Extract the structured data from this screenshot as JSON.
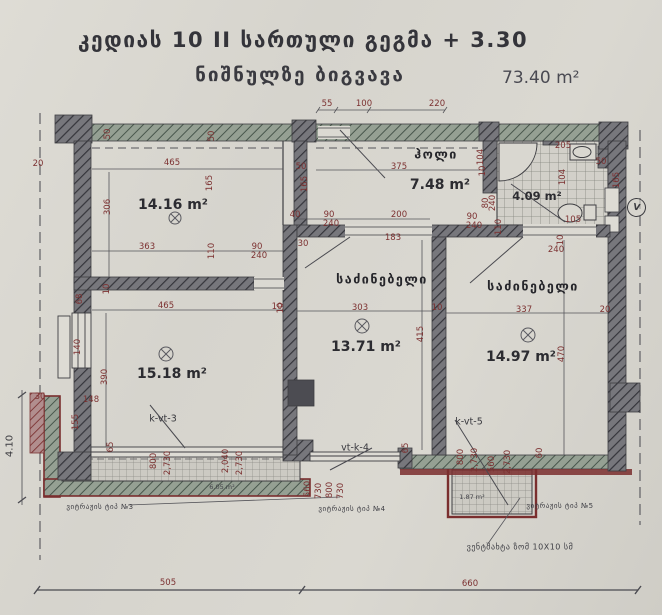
{
  "header": {
    "line1": "კედიას 10 II სართული გეგმა + 3.30",
    "line2": "ნიშნულზე ბიგვავა",
    "total_area": "73.40 m²"
  },
  "rooms": [
    {
      "name": "",
      "area": "14.16 m²"
    },
    {
      "name": "ჰოლი",
      "area": "7.48 m²"
    },
    {
      "name": "",
      "area": "4.09 m²"
    },
    {
      "name": "საძინებელი",
      "area": "13.71 m²"
    },
    {
      "name": "საძინებელი",
      "area": "14.97 m²"
    },
    {
      "name": "",
      "area": "15.18 m²"
    }
  ],
  "window_labels": {
    "left": "k-vt-3",
    "middle": "vt-k-4",
    "right": "k-vt-5"
  },
  "balcony_areas": {
    "left": "6.05 m²",
    "right": "1.87 m²"
  },
  "notes": {
    "type3": "ვიტრაჟის ტიპ №3",
    "type4": "ვიტრაჟის ტიპ №4",
    "type5": "ვიტრაჟის ტიპ №5",
    "vent": "ვენტშახტა ზომ 10X10 სმ",
    "elevation": "4.10",
    "vent_symbol": "V"
  },
  "bottom_dims": {
    "left": "505",
    "right": "660"
  },
  "colors": {
    "paper": "#d6d4cd",
    "ink": "#3b3b40",
    "dimension_text": "#7c3131",
    "wall_dark": "#75757a",
    "wall_green": "#94a092",
    "maroon_band": "#7a2e2e"
  },
  "dim_labels": [
    {
      "t": "55",
      "x": 327,
      "y": 104
    },
    {
      "t": "100",
      "x": 364,
      "y": 104
    },
    {
      "t": "220",
      "x": 437,
      "y": 104
    },
    {
      "t": "50",
      "x": 108,
      "y": 134,
      "r": 1
    },
    {
      "t": "50",
      "x": 212,
      "y": 136,
      "r": 1
    },
    {
      "t": "20",
      "x": 38,
      "y": 164
    },
    {
      "t": "465",
      "x": 172,
      "y": 163
    },
    {
      "t": "165",
      "x": 210,
      "y": 183,
      "r": 1
    },
    {
      "t": "306",
      "x": 108,
      "y": 207,
      "r": 1
    },
    {
      "t": "363",
      "x": 147,
      "y": 247
    },
    {
      "t": "110",
      "x": 212,
      "y": 251,
      "r": 1
    },
    {
      "t": "90",
      "x": 257,
      "y": 247
    },
    {
      "t": "240",
      "x": 259,
      "y": 256
    },
    {
      "t": "50",
      "x": 301,
      "y": 167
    },
    {
      "t": "165",
      "x": 305,
      "y": 184,
      "r": 1
    },
    {
      "t": "40",
      "x": 295,
      "y": 215
    },
    {
      "t": "90",
      "x": 329,
      "y": 215
    },
    {
      "t": "240",
      "x": 331,
      "y": 224
    },
    {
      "t": "30",
      "x": 303,
      "y": 244
    },
    {
      "t": "375",
      "x": 399,
      "y": 167
    },
    {
      "t": "104",
      "x": 481,
      "y": 157,
      "r": 1
    },
    {
      "t": "10",
      "x": 483,
      "y": 171,
      "r": 1
    },
    {
      "t": "80",
      "x": 486,
      "y": 203,
      "r": 1
    },
    {
      "t": "240",
      "x": 493,
      "y": 203,
      "r": 1
    },
    {
      "t": "90",
      "x": 472,
      "y": 217
    },
    {
      "t": "240",
      "x": 474,
      "y": 226
    },
    {
      "t": "110",
      "x": 499,
      "y": 227,
      "r": 1
    },
    {
      "t": "200",
      "x": 399,
      "y": 215
    },
    {
      "t": "183",
      "x": 393,
      "y": 238
    },
    {
      "t": "205",
      "x": 563,
      "y": 146
    },
    {
      "t": "104",
      "x": 563,
      "y": 177,
      "r": 1
    },
    {
      "t": "105",
      "x": 573,
      "y": 220
    },
    {
      "t": "10",
      "x": 561,
      "y": 240,
      "r": 1
    },
    {
      "t": "240",
      "x": 556,
      "y": 250
    },
    {
      "t": "50",
      "x": 601,
      "y": 162
    },
    {
      "t": "165",
      "x": 617,
      "y": 180,
      "r": 1
    },
    {
      "t": "303",
      "x": 360,
      "y": 308
    },
    {
      "t": "10",
      "x": 281,
      "y": 308,
      "r": 1
    },
    {
      "t": "10",
      "x": 437,
      "y": 308
    },
    {
      "t": "415",
      "x": 421,
      "y": 334,
      "r": 1
    },
    {
      "t": "337",
      "x": 524,
      "y": 310
    },
    {
      "t": "20",
      "x": 605,
      "y": 310
    },
    {
      "t": "470",
      "x": 562,
      "y": 354,
      "r": 1
    },
    {
      "t": "465",
      "x": 166,
      "y": 306
    },
    {
      "t": "10",
      "x": 277,
      "y": 307
    },
    {
      "t": "68",
      "x": 80,
      "y": 299,
      "r": 1
    },
    {
      "t": "10",
      "x": 107,
      "y": 289,
      "r": 1
    },
    {
      "t": "140",
      "x": 78,
      "y": 347,
      "r": 1
    },
    {
      "t": "390",
      "x": 105,
      "y": 377,
      "r": 1
    },
    {
      "t": "148",
      "x": 91,
      "y": 400
    },
    {
      "t": "155",
      "x": 76,
      "y": 422,
      "r": 1
    },
    {
      "t": "65",
      "x": 111,
      "y": 447,
      "r": 1
    },
    {
      "t": "30",
      "x": 40,
      "y": 397
    },
    {
      "t": "800",
      "x": 154,
      "y": 461,
      "r": 1
    },
    {
      "t": "2,730",
      "x": 168,
      "y": 463,
      "r": 1
    },
    {
      "t": "2,040",
      "x": 226,
      "y": 461,
      "r": 1
    },
    {
      "t": "2,730",
      "x": 240,
      "y": 463,
      "r": 1
    },
    {
      "t": "560",
      "x": 308,
      "y": 489,
      "r": 1
    },
    {
      "t": "730",
      "x": 319,
      "y": 491,
      "r": 1
    },
    {
      "t": "800",
      "x": 330,
      "y": 490,
      "r": 1
    },
    {
      "t": "730",
      "x": 341,
      "y": 491,
      "r": 1
    },
    {
      "t": "65",
      "x": 406,
      "y": 448,
      "r": 1
    },
    {
      "t": "800",
      "x": 461,
      "y": 457,
      "r": 1
    },
    {
      "t": "2,730",
      "x": 475,
      "y": 460,
      "r": 1
    },
    {
      "t": "560",
      "x": 492,
      "y": 464,
      "r": 1
    },
    {
      "t": "2,730",
      "x": 508,
      "y": 462,
      "r": 1
    },
    {
      "t": "60",
      "x": 540,
      "y": 453,
      "r": 1
    },
    {
      "t": "505",
      "x": 168,
      "y": 583
    },
    {
      "t": "660",
      "x": 470,
      "y": 584
    }
  ]
}
